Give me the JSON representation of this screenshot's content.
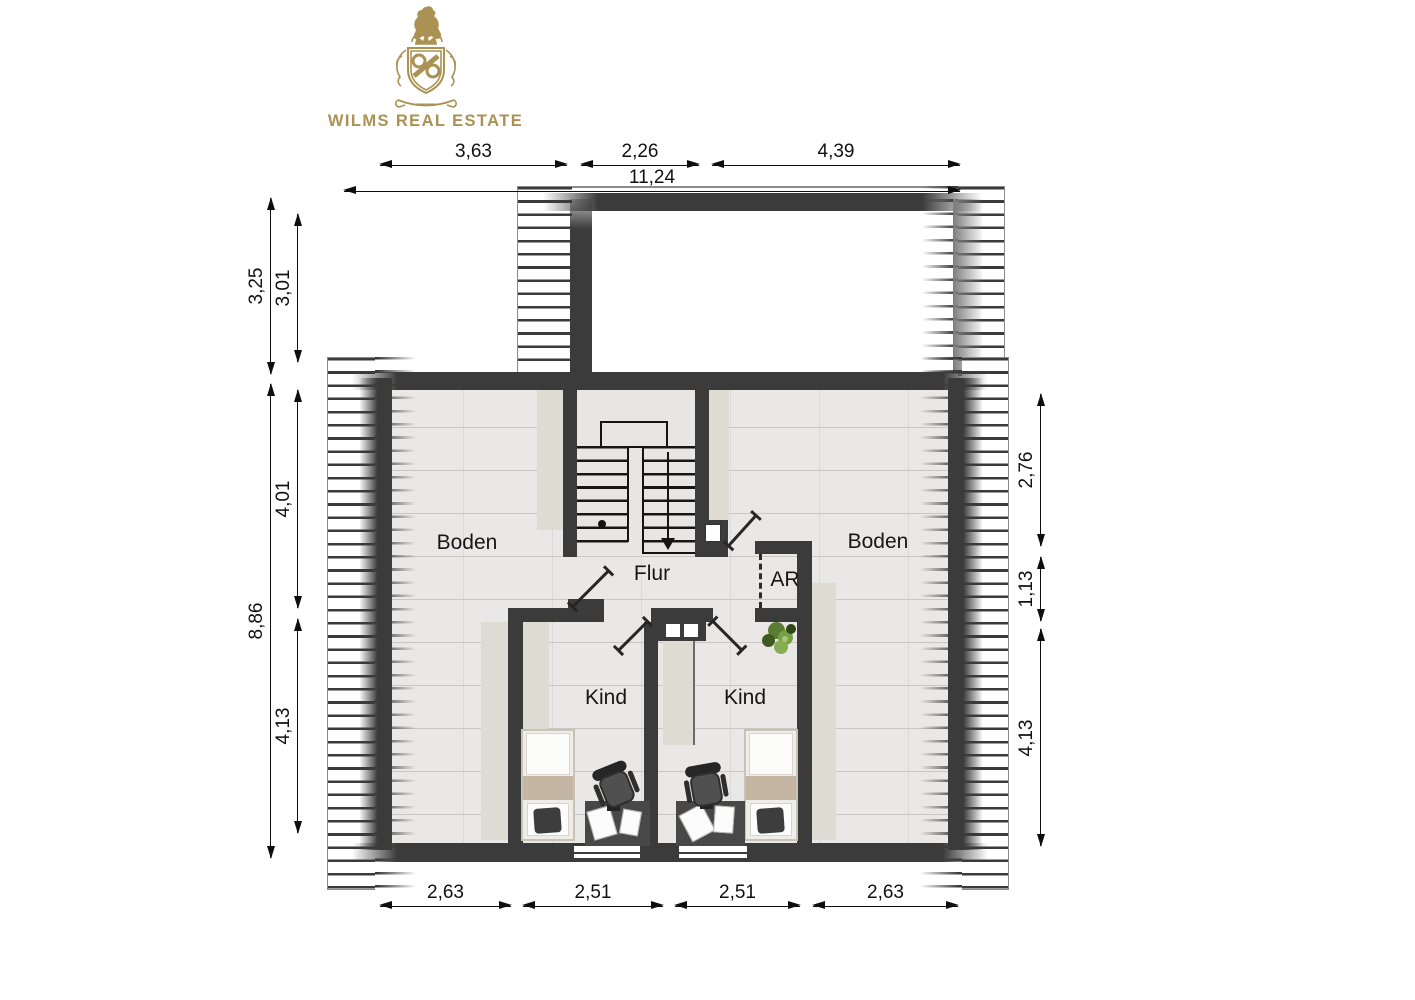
{
  "brand": {
    "name": "WILMS REAL ESTATE"
  },
  "floorplan": {
    "rooms": {
      "boden_left": "Boden",
      "boden_right": "Boden",
      "flur": "Flur",
      "ar": "AR",
      "kind_left": "Kind",
      "kind_right": "Kind"
    },
    "dimensions": {
      "top_segments": [
        "3,63",
        "2,26",
        "4,39"
      ],
      "top_total": "11,24",
      "left_upper": [
        "3,25",
        "3,01"
      ],
      "left_total": "8,86",
      "left_segments": [
        "4,01",
        "4,13"
      ],
      "right_segments": [
        "2,76",
        "1,13",
        "4,13"
      ],
      "bottom_segments": [
        "2,63",
        "2,51",
        "2,51",
        "2,63"
      ]
    }
  },
  "colors": {
    "brand_gold": "#ab9254",
    "wall": "#3b3b3b",
    "floor": "#e9e8e6",
    "knee_wall": "#dedbd3",
    "stair_floor": "#e7e6e4",
    "blanket": "#c4b6a2",
    "plant_green": "#6d9040"
  }
}
